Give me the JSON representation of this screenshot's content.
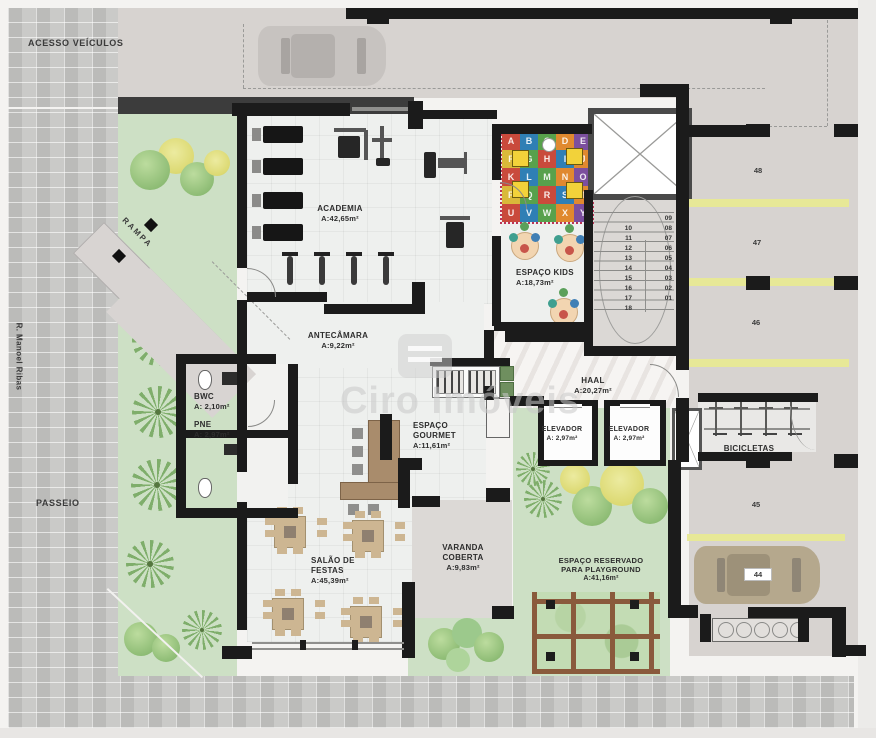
{
  "site": {
    "vehicle_access_label": "ACESSO VEÍCULOS",
    "sidewalk_label": "PASSEIO",
    "street_label": "R. Manoel Ribas",
    "ramp_label": "RAMPA"
  },
  "watermark": "Ciro Imóveis",
  "rooms": {
    "academia": {
      "name": "ACADEMIA",
      "area": "A:42,65m²"
    },
    "espaco_kids": {
      "name": "ESPAÇO KIDS",
      "area": "A:18,73m²"
    },
    "antecamara": {
      "name": "ANTECÂMARA",
      "area": "A:9,22m²"
    },
    "haal": {
      "name": "HAAL",
      "area": "A:20,27m²"
    },
    "bwc": {
      "name": "BWC",
      "area": "A: 2,10m²"
    },
    "pne": {
      "name": "PNE",
      "area": "A: 2,97m²"
    },
    "espaco_gourmet": {
      "name": "ESPAÇO GOURMET",
      "area": "A:11,61m²"
    },
    "elevador_1": {
      "name": "ELEVADOR",
      "area": "A: 2,97m²"
    },
    "elevador_2": {
      "name": "ELEVADOR",
      "area": "A: 2,97m²"
    },
    "salao_festas": {
      "name": "SALÃO DE FESTAS",
      "area": "A:45,39m²"
    },
    "varanda": {
      "name": "VARANDA COBERTA",
      "area": "A:9,83m²"
    },
    "playground": {
      "name": "ESPAÇO RESERVADO PARA PLAYGROUND",
      "area": "A:41,16m²"
    },
    "bicicletas": {
      "name": "BICICLETAS"
    }
  },
  "parking_spots": [
    "48",
    "47",
    "46",
    "45",
    "44"
  ],
  "stairs": {
    "right_steps": [
      "09",
      "08",
      "07",
      "06",
      "05",
      "04",
      "03",
      "02",
      "01"
    ],
    "left_steps": [
      "10",
      "11",
      "12",
      "13",
      "14",
      "15",
      "16",
      "17",
      "18"
    ]
  },
  "kids_mat": {
    "letters": [
      "A",
      "B",
      "C",
      "D",
      "E",
      "F",
      "G",
      "H",
      "I",
      "J",
      "K",
      "L",
      "M",
      "N",
      "O",
      "P",
      "Q",
      "R",
      "S",
      "T",
      "U",
      "V",
      "W",
      "X",
      "Y"
    ]
  },
  "palette": {
    "wall_black": "#1b1b1b",
    "landscape_green": "#cde0c5",
    "parking_divider_yellow": "#e7e897",
    "paving_gray": "#c5c5c3",
    "driveway_gray": "#d7d3d0",
    "floor_light": "#eef0ee",
    "mat_red": "#c94a3c",
    "seat_yellow": "#f2d23a"
  }
}
